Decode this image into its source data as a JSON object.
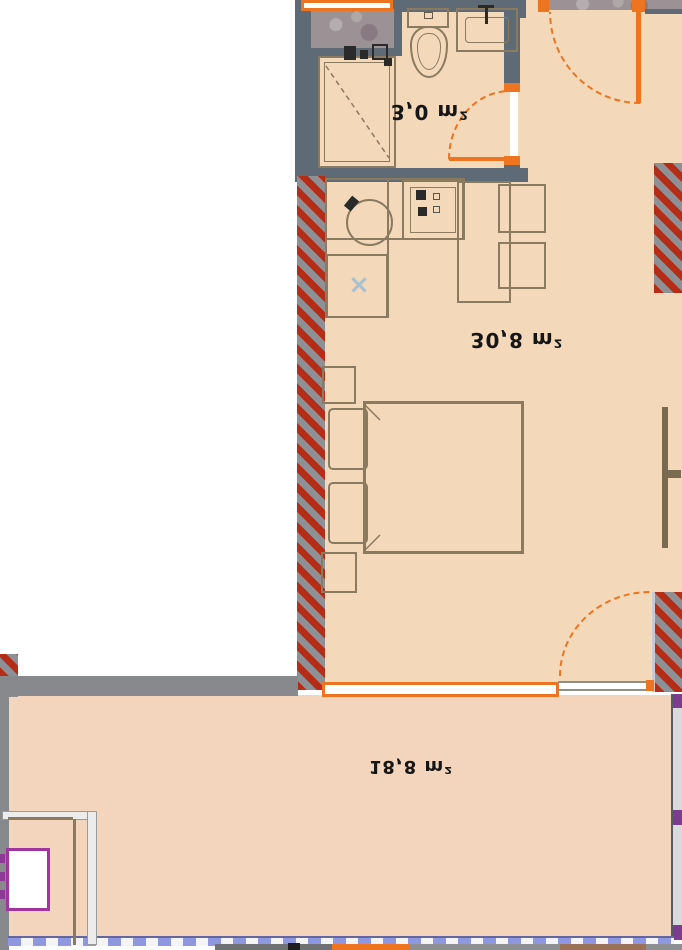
{
  "plan_type": "apartment-floor-plan",
  "area_labels": {
    "bathroom": "3,0 m²",
    "living_room": "30,8 m²",
    "balcony": "18,8 m²"
  },
  "colors": {
    "floor": "#f3d8ba",
    "balcony_floor": "#f2d5bc",
    "wall_slate": "#5e6b76",
    "wall_gray": "#87898c",
    "hatch_red": "#b62d17",
    "hatch_gray": "#8d9196",
    "accent_orange": "#ee7420",
    "railing_blue": "#8f97e0",
    "purple_accent": "#a035a0",
    "stone": "#9c9194",
    "furniture_line": "#8a7a5f"
  },
  "fixtures": [
    "shower",
    "toilet",
    "washbasin",
    "sink-tap",
    "kitchen-sink",
    "stove",
    "kitchen-cabinet",
    "kitchen-counter",
    "dining-table",
    "chair",
    "bed",
    "pillow",
    "nightstand",
    "tv",
    "entrance-door",
    "bathroom-door",
    "balcony-door",
    "window",
    "balcony-railing",
    "utility-box",
    "hatched-wall"
  ]
}
